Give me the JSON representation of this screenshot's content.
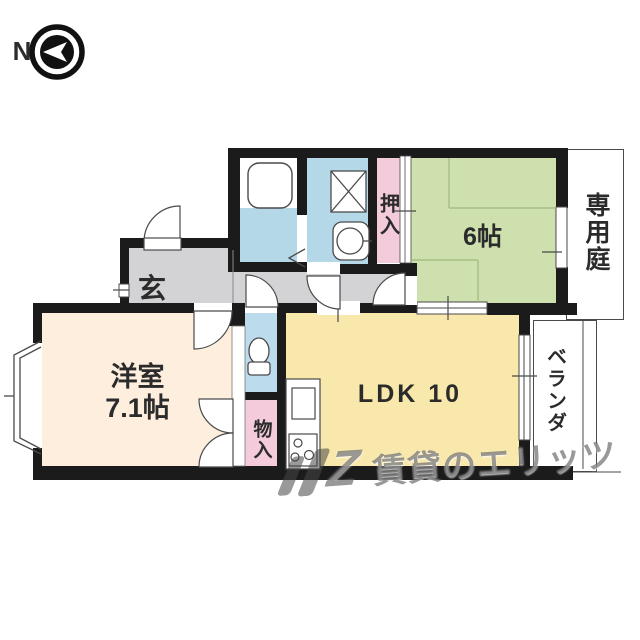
{
  "compass": {
    "north_label": "N"
  },
  "rooms": {
    "entrance": {
      "label": "玄"
    },
    "western_room": {
      "label_line1": "洋室",
      "label_line2": "7.1帖"
    },
    "ldk": {
      "label": "LDK 10"
    },
    "tatami_room": {
      "label": "6帖"
    },
    "closet": {
      "label": "押入"
    },
    "storage": {
      "label": "物入"
    },
    "private_garden": {
      "label": "専用庭"
    },
    "veranda": {
      "label": "ベランダ"
    }
  },
  "watermark": {
    "logo_letter": "Z",
    "text": "賃貸のエリッツ"
  },
  "icons": {
    "compass": "north-compass-icon",
    "bathtub": "bathtub-icon",
    "washing_machine": "washing-machine-icon",
    "washbasin": "washbasin-icon",
    "toilet": "toilet-icon",
    "kitchen_sink": "kitchen-sink-icon",
    "stove": "stove-burner-icon",
    "watermark_logo": "watermark-logo-icon"
  },
  "colors": {
    "wall": "#1b1b1b",
    "water_blue": "#b5d8e9",
    "toilet_blue": "#bcdcee",
    "closet_pink": "#f3cbdb",
    "tatami_green": "#cde0ad",
    "ldk_yellow": "#f9e8ac",
    "room_peach": "#fdeedd",
    "hall_gray": "#d3d3d5",
    "line": "#4a4a4a",
    "text": "#2b2b2b",
    "watermark": "rgba(70,70,70,0.55)"
  }
}
